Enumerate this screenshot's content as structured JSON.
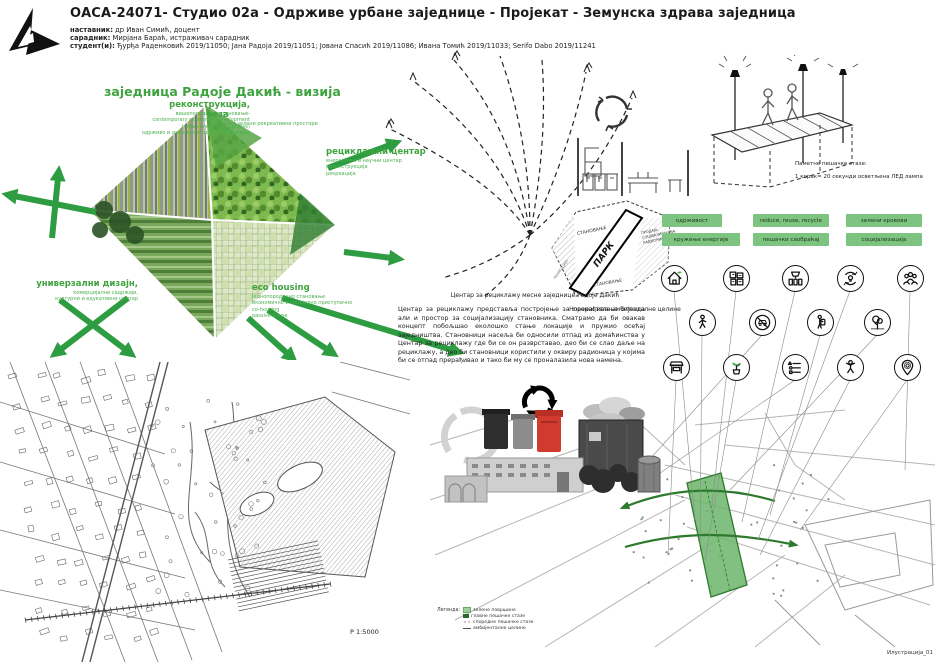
{
  "header": {
    "title": "ОАСА-24071- Студио 02а - Одрживе урбане заједнице - Пројекат - Земунска здрава заједница",
    "teacher_label": "наставник:",
    "teacher": "др Иван Симић, доцент",
    "associate_label": "сарадник:",
    "associate": "Мирјана Бараћ, истраживач сарадник",
    "students_label": "студент(и):",
    "students": "Ђурђа Раденковић 2019/11050; Јана Радоја 2019/11051; Јована Спасић 2019/11086; Ивана Томић 2019/11033; Serifo Dabo 2019/11241"
  },
  "vision": {
    "title": "заједница Радоје Дакић - визија",
    "reconstruction": {
      "heading": "реконструкција,",
      "line1": "вишепородично становање-",
      "line2": "contemporary residential development",
      "line3": "(urban and green qualities)",
      "line4": "одрживо и динамично здраво окружење"
    },
    "connection": {
      "heading": "веза",
      "line1": "централни зелени рекреативни простори",
      "line2": "заједница"
    },
    "recycling_center": {
      "heading": "рециклажни центар",
      "line1": "енергетски и научни центар",
      "line2": "реконструкција",
      "line3": "рекреација"
    },
    "universal_design": {
      "heading": "универзални дизајн,",
      "line1": "комерцијални садржаји,",
      "line2": "културни и едукативни центар"
    },
    "eco_housing": {
      "heading": "eco housing",
      "line1": "једнопородично становање",
      "line2": "економично и социјално приступачно",
      "line3": "co-housing",
      "line4": "passive house"
    }
  },
  "smart_path": {
    "caption_title": "Паметне пешачке стазе:",
    "caption_text": "1 корак= 20 секунди осветљена ЛЕД лампа"
  },
  "principles": {
    "buttons": [
      "одрживост",
      "reduce, reuse, recycle",
      "зелени кровови",
      "кружење енергије",
      "пешачки саобраћај",
      "социјализација"
    ]
  },
  "zone_diagram": {
    "zone_housing_top": "СТАНОВАЊЕ",
    "zone_park": "ПАРК",
    "zone_mixed_1": "ПРОДАЈА,",
    "zone_mixed_2": "СОЦИЈАЛИЗАЦИЈА,",
    "zone_mixed_3": "РАДИОНИЦЕ",
    "zone_housing_bottom": "СТАНОВАЊЕ",
    "zone_recreation": "РЕКРЕАЦИЈА"
  },
  "recycling_text": {
    "caption": "Центар за рециклажу месне заједнице Радоје Дакић",
    "paragraph": "Центар за рециклажу представља постројење за прерађивање отпада али и простор за социјализацију становника. Сматрамо да би овакав концепт побољшао еколошко стање локације и пружио осећај заједништва. Становници насеља би односили отпад из домаћинства у Центар за рециклажу где би се он разврставао, део би се слао даље на рециклажу, а део би становници користили у оквиру радионица у којима би се отпад прерађивао и тако би му се проналазила нова намена."
  },
  "ambient_label": "Новонастале амбијенталне целине",
  "icon_rows": [
    [
      "eco-house",
      "recycled-materials",
      "waste-sorting",
      "energy-cycle",
      "community"
    ],
    [
      "pedestrian",
      "car-free",
      "eco-backpack",
      "tree-park"
    ],
    [
      "market",
      "sprout",
      "reduce-reuse-recycle",
      "active-person",
      "location-pin"
    ]
  ],
  "site_map": {
    "scale_label": "Р 1:5000"
  },
  "overlay_map": {
    "legend_title": "Легенда:",
    "legend_items": [
      {
        "swatch": "green-area",
        "label": "зелене површине"
      },
      {
        "swatch": "main-path",
        "label": "главне пешачке стазе"
      },
      {
        "swatch": "secondary-path",
        "label": "споредне пешачке стазе"
      },
      {
        "swatch": "ambient-unit",
        "label": "амбијенталне целине"
      }
    ]
  },
  "footer": {
    "illustration_label": "Илустрација_01"
  },
  "colors": {
    "accent_green": "#3fa33f",
    "arrow_green": "#2e9c41",
    "button_green": "#7cc47f",
    "band_green": "#6cb56c",
    "bin_red": "#d13a2e"
  }
}
